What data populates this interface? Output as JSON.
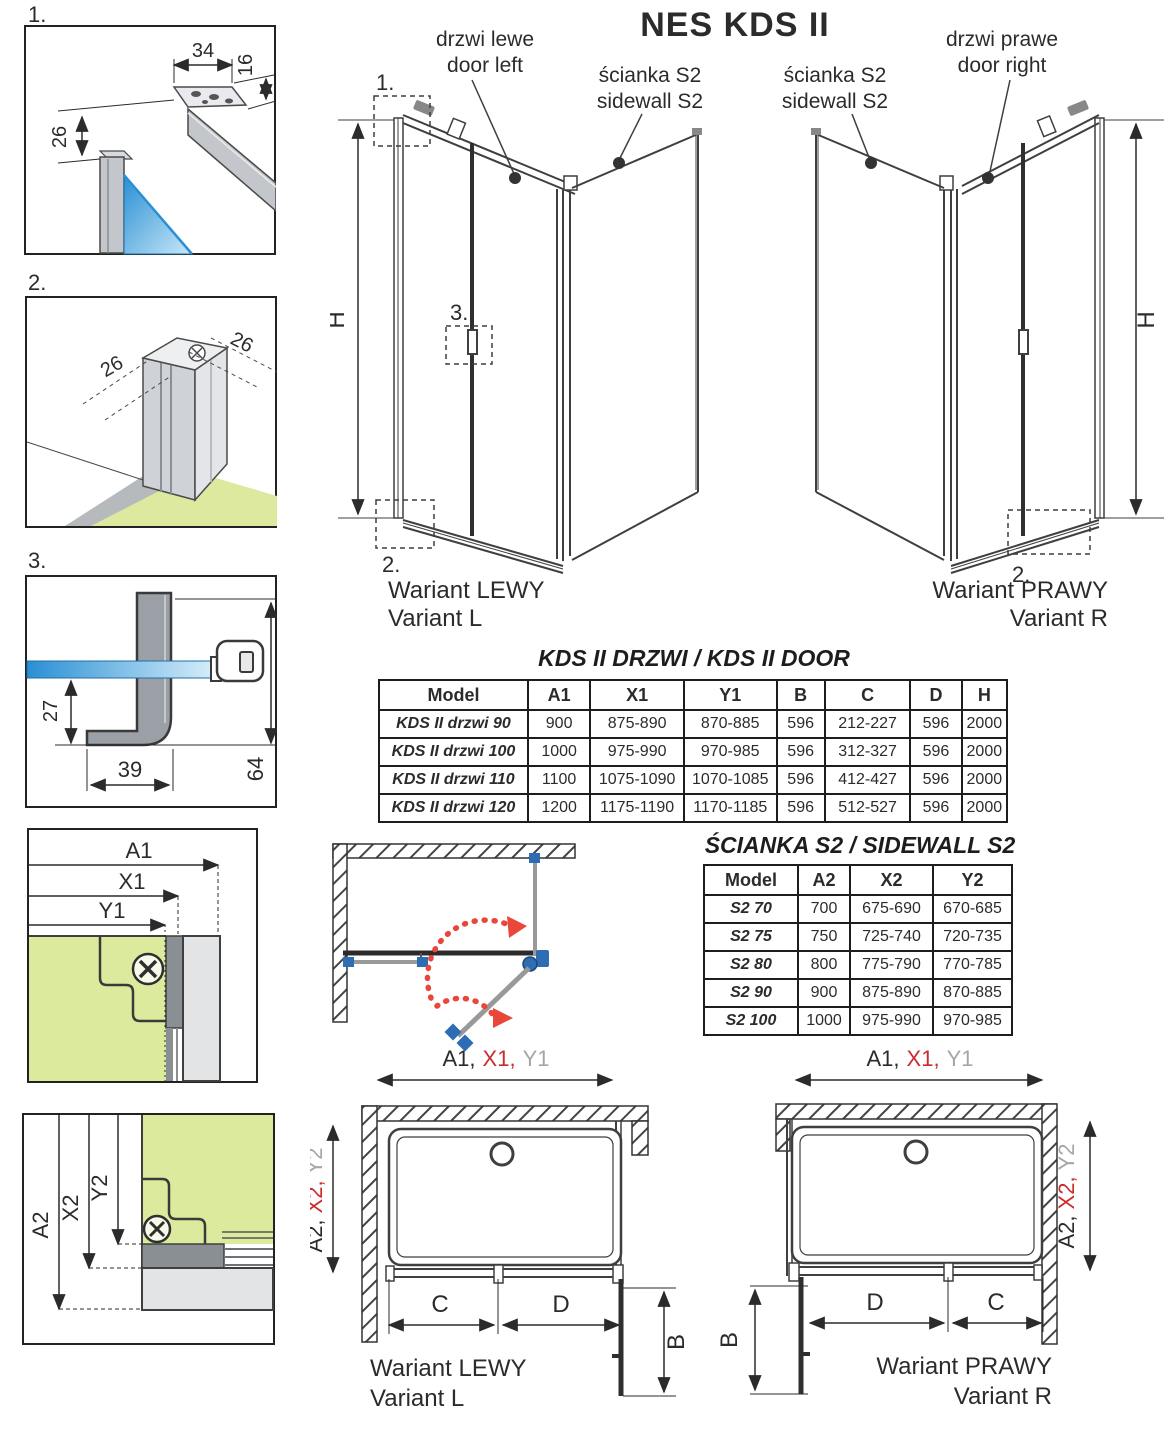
{
  "page": {
    "title": "NES KDS II"
  },
  "details": {
    "d1": {
      "marker": "1.",
      "dim_width": "34",
      "dim_depth": "16",
      "dim_height": "26"
    },
    "d2": {
      "marker": "2.",
      "dim_left": "26",
      "dim_right": "26"
    },
    "d3": {
      "marker": "3.",
      "dim_offset": "27",
      "dim_foot": "39",
      "dim_total": "64"
    },
    "plan_top": {
      "a1": "A1",
      "x1": "X1",
      "y1": "Y1"
    },
    "plan_bottom": {
      "a2": "A2",
      "x2": "X2",
      "y2": "Y2"
    }
  },
  "views": {
    "left": {
      "door_l1": "drzwi lewe",
      "door_l2": "door left",
      "side_l1": "ścianka S2",
      "side_l2": "sidewall S2",
      "h": "H",
      "m1": "1.",
      "m2": "2.",
      "m3": "3.",
      "variant_l1": "Wariant LEWY",
      "variant_l2": "Variant L"
    },
    "right": {
      "door_l1": "drzwi prawe",
      "door_l2": "door right",
      "side_l1": "ścianka S2",
      "side_l2": "sidewall S2",
      "h": "H",
      "m2": "2.",
      "variant_l1": "Wariant PRAWY",
      "variant_l2": "Variant R"
    }
  },
  "door_table": {
    "title": "KDS II DRZWI / KDS II DOOR",
    "headers": [
      "Model",
      "A1",
      "X1",
      "Y1",
      "B",
      "C",
      "D",
      "H"
    ],
    "rows": [
      [
        "KDS II drzwi 90",
        "900",
        "875-890",
        "870-885",
        "596",
        "212-227",
        "596",
        "2000"
      ],
      [
        "KDS II drzwi 100",
        "1000",
        "975-990",
        "970-985",
        "596",
        "312-327",
        "596",
        "2000"
      ],
      [
        "KDS II drzwi 110",
        "1100",
        "1075-1090",
        "1070-1085",
        "596",
        "412-427",
        "596",
        "2000"
      ],
      [
        "KDS II drzwi 120",
        "1200",
        "1175-1190",
        "1170-1185",
        "596",
        "512-527",
        "596",
        "2000"
      ]
    ]
  },
  "sidewall_table": {
    "title": "ŚCIANKA S2 / SIDEWALL S2",
    "headers": [
      "Model",
      "A2",
      "X2",
      "Y2"
    ],
    "rows": [
      [
        "S2 70",
        "700",
        "675-690",
        "670-685"
      ],
      [
        "S2 75",
        "750",
        "725-740",
        "720-735"
      ],
      [
        "S2 80",
        "800",
        "775-790",
        "770-785"
      ],
      [
        "S2 90",
        "900",
        "875-890",
        "870-885"
      ],
      [
        "S2 100",
        "1000",
        "975-990",
        "970-985"
      ]
    ]
  },
  "plans": {
    "left": {
      "w_a1": "A1,",
      "w_x1": "X1,",
      "w_y1": "Y1",
      "d_a2": "A2,",
      "d_x2": "X2,",
      "d_y2": "Y2",
      "c": "C",
      "d": "D",
      "b": "B",
      "variant_l1": "Wariant LEWY",
      "variant_l2": "Variant L"
    },
    "right": {
      "w_a1": "A1,",
      "w_x1": "X1,",
      "w_y1": "Y1",
      "d_a2": "A2,",
      "d_x2": "X2,",
      "d_y2": "Y2",
      "c": "C",
      "d": "D",
      "b": "B",
      "variant_l1": "Wariant PRAWY",
      "variant_l2": "Variant R"
    }
  },
  "colors": {
    "red": "#cc2b2b",
    "gray": "#a6a6a6",
    "blue": "#2e64b5",
    "green": "#7cc576",
    "indigo": "#5c5ea8",
    "floor": "#dcea9e",
    "glass": "#2a8fd4"
  }
}
